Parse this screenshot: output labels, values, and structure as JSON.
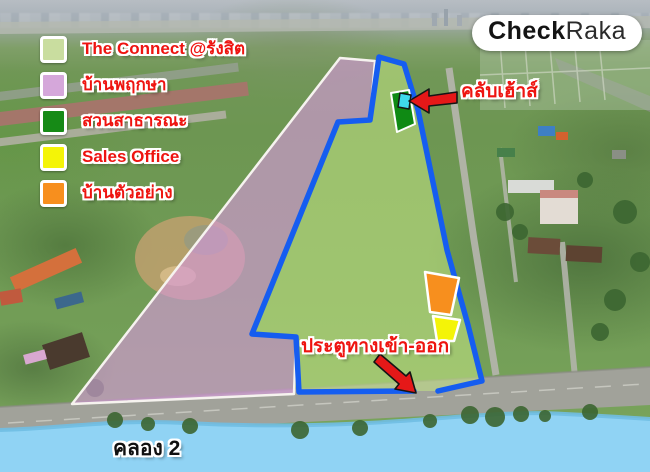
{
  "brand": {
    "bold": "Check",
    "light": "Raka"
  },
  "legend": {
    "items": [
      {
        "label": "The Connect @รังสิต",
        "color": "#c9dd9f"
      },
      {
        "label": "บ้านพฤกษา",
        "color": "#d5a7da"
      },
      {
        "label": "สวนสาธารณะ",
        "color": "#168a16"
      },
      {
        "label": "Sales Office",
        "color": "#f4f407"
      },
      {
        "label": "บ้านตัวอย่าง",
        "color": "#f78f1e"
      }
    ]
  },
  "map_labels": {
    "clubhouse": "คลับเฮ้าส์",
    "entrance": "ประตูทางเข้า-ออก",
    "canal": "คลอง 2"
  },
  "colors": {
    "label_red": "#ee1410",
    "boundary_blue": "#155df0",
    "site_fill": "rgba(197,229,133,0.55)",
    "pruksa_fill": "rgba(214,152,219,0.63)",
    "park_green": "#0f8a14",
    "clubhouse_cyan": "#3fd9ec",
    "sales_yellow": "#f4f407",
    "example_orange": "#f78f1e",
    "canal_blue": "#90d3f4",
    "arrow_red": "#e51818",
    "canal_text": "#101010"
  }
}
